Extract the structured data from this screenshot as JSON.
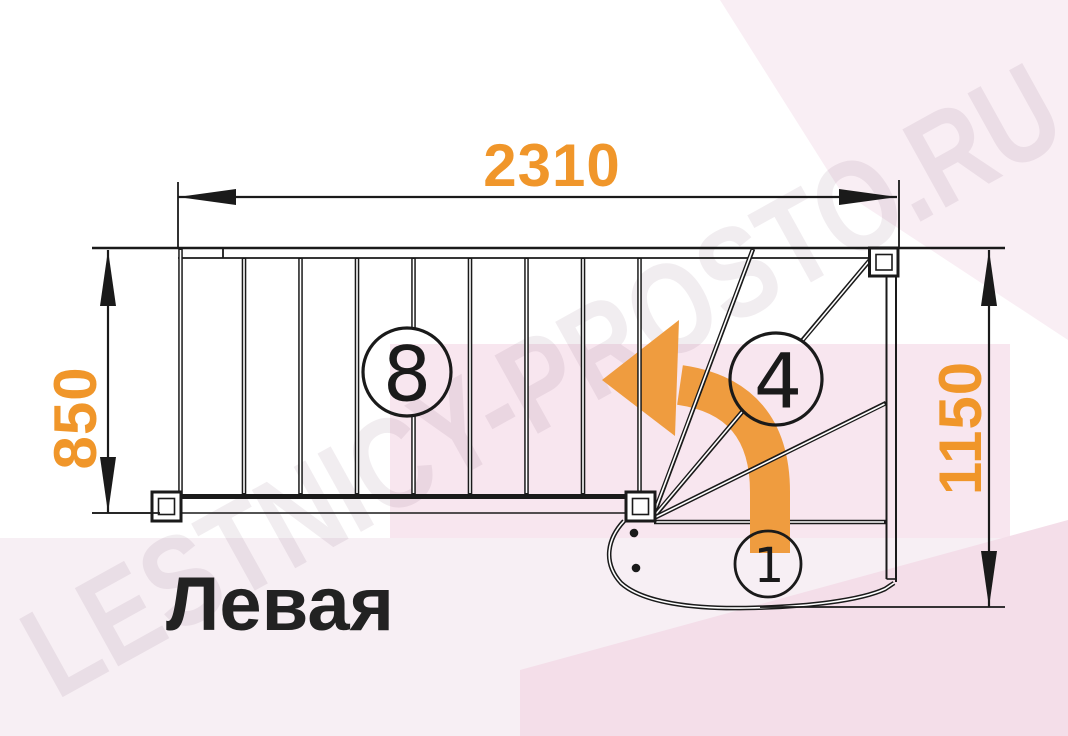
{
  "title": "Левая",
  "watermark": "LESTNICY-PROSTO.RU",
  "dimensions": {
    "top_width": "2310",
    "left_height": "850",
    "right_height": "1150"
  },
  "step_labels": {
    "straight_flight": "8",
    "winder": "4",
    "first_step": "1"
  },
  "colors": {
    "accent": "#F0962A",
    "arrow": "#EF9C3F",
    "label": "#222222",
    "pink_rect": "#F8E6EF",
    "pink_band": "#F7EFF4",
    "pink_corner": "#F4DEE9",
    "pink_topright": "#F9EEF4",
    "watermark_color": "rgba(122,74,104,0.10)"
  }
}
